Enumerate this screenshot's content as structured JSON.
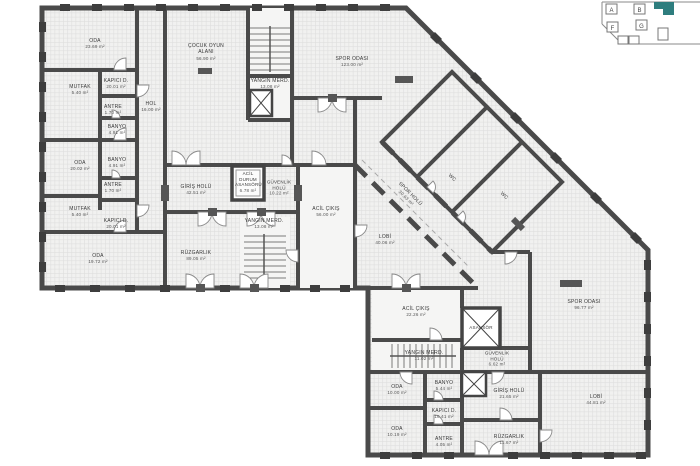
{
  "colors": {
    "wall": "#4a4a4a",
    "floor": "#f1f1f0",
    "grid": "#dedede",
    "accent": "#2e7d7e"
  },
  "key_plan": {
    "blocks": [
      "A",
      "B",
      "F",
      "G"
    ]
  },
  "rooms": [
    {
      "label": "ODA",
      "area": "23.69 m²"
    },
    {
      "label": "MUTFAK",
      "area": "5.40 m²"
    },
    {
      "label": "KAPICI D.",
      "area": "20.01 m²"
    },
    {
      "label": "HOL",
      "area": "16.00 m²"
    },
    {
      "label": "ANTRE",
      "area": "1.70 m²"
    },
    {
      "label": "BANYO",
      "area": "4.91 m²"
    },
    {
      "label": "ODA",
      "area": "20.02 m²"
    },
    {
      "label": "BANYO",
      "area": "4.91 m²"
    },
    {
      "label": "ANTRE",
      "area": "1.70 m²"
    },
    {
      "label": "MUTFAK",
      "area": "5.40 m²"
    },
    {
      "label": "KAPICI D.",
      "area": "20.01 m²"
    },
    {
      "label": "ODA",
      "area": "19.72 m²"
    },
    {
      "label": "ÇOCUK OYUN ALANI",
      "area": "56.90 m²"
    },
    {
      "label": "YANGIN MERD.",
      "area": "13.08 m²"
    },
    {
      "label": "SPOR ODASI",
      "area": "123.00 m²"
    },
    {
      "label": "GİRİŞ HOLÜ",
      "area": "42.51 m²"
    },
    {
      "label": "RÜZGARLIK",
      "area": "89.05 m²"
    },
    {
      "label": "ACİL DURUM ASANSÖRÜ",
      "area": "6.78 m²"
    },
    {
      "label": "GÜVENLİK HOLÜ",
      "area": "10.22 m²"
    },
    {
      "label": "YANGIN MERD.",
      "area": "13.08 m²"
    },
    {
      "label": "ACİL ÇIKIŞ",
      "area": "56.00 m²"
    },
    {
      "label": "LOBİ",
      "area": "40.06 m²"
    },
    {
      "label": "SPOR HOLÜ",
      "area": "30.63 m²"
    },
    {
      "label": "WC"
    },
    {
      "label": "WC"
    },
    {
      "label": "SPOR ODASI",
      "area": "96.77 m²"
    },
    {
      "label": "ACİL ÇIKIŞ",
      "area": "22.26 m²"
    },
    {
      "label": "ASANSÖR"
    },
    {
      "label": "YANGIN MERD.",
      "area": "11.02 m²"
    },
    {
      "label": "GÜVENLİK HOLÜ",
      "area": "6.62 m²"
    },
    {
      "label": "ODA",
      "area": "10.00 m²"
    },
    {
      "label": "BANYO",
      "area": "5.44 m²"
    },
    {
      "label": "KAPICI D.",
      "area": "10.41 m²"
    },
    {
      "label": "ODA",
      "area": "10.19 m²"
    },
    {
      "label": "ANTRE",
      "area": "4.05 m²"
    },
    {
      "label": "GİRİŞ HOLÜ",
      "area": "21.65 m²"
    },
    {
      "label": "RÜZGARLIK",
      "area": "11.67 m²"
    },
    {
      "label": "LOBİ",
      "area": "44.81 m²"
    }
  ]
}
